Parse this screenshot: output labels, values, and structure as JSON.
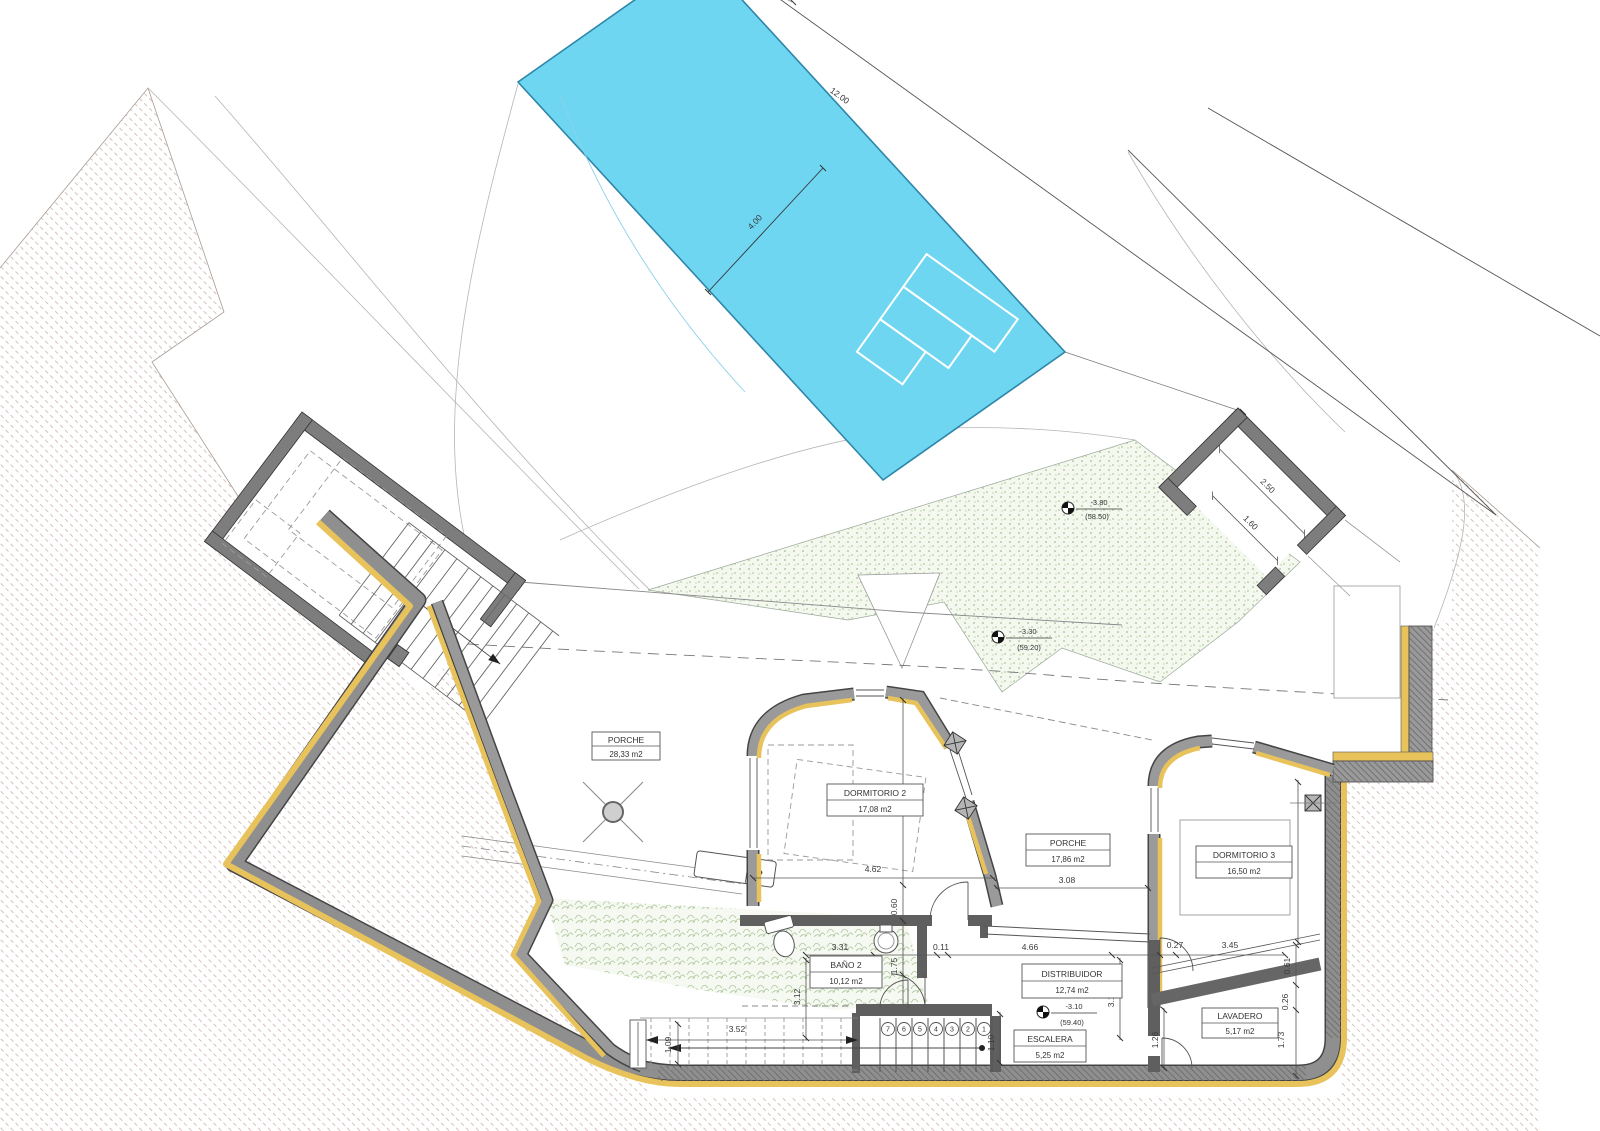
{
  "drawing": {
    "type": "architectural-floor-plan",
    "colors": {
      "pool_fill": "#6FD6F2",
      "pool_border": "#2E86A8",
      "insulation_yellow": "#E8C35B",
      "wall_gray": "#8F8F8F",
      "partition_gray": "#5F5F5F",
      "earth_hatch": "#D2BEB5",
      "vegetation_green": "#9CBF8C"
    }
  },
  "pool": {
    "length_label": "12.00",
    "width_label": "4.00"
  },
  "rooms": [
    {
      "name": "PORCHE",
      "area": "28,33 m2"
    },
    {
      "name": "DORMITORIO 2",
      "area": "17,08 m2"
    },
    {
      "name": "PORCHE",
      "area": "17,86 m2"
    },
    {
      "name": "DORMITORIO 3",
      "area": "16,50 m2"
    },
    {
      "name": "BAÑO 2",
      "area": "10,12 m2"
    },
    {
      "name": "DISTRIBUIDOR",
      "area": "12,74 m2"
    },
    {
      "name": "ESCALERA",
      "area": "5,25 m2"
    },
    {
      "name": "LAVADERO",
      "area": "5,17 m2"
    }
  ],
  "levels": [
    {
      "value": "-3.80",
      "elevation": "(58.50)"
    },
    {
      "value": "-3.30",
      "elevation": "(59.20)"
    },
    {
      "value": "-3.10",
      "elevation": "(59.40)"
    }
  ],
  "dims": [
    {
      "t": "12.00"
    },
    {
      "t": "4.00"
    },
    {
      "t": "2.50"
    },
    {
      "t": "1.60"
    },
    {
      "t": "3.53"
    },
    {
      "t": "4.62"
    },
    {
      "t": "3.08"
    },
    {
      "t": "3.96"
    },
    {
      "t": "0.60"
    },
    {
      "t": "3.31"
    },
    {
      "t": "0.11"
    },
    {
      "t": "1.75"
    },
    {
      "t": "4.66"
    },
    {
      "t": "0.27"
    },
    {
      "t": "3.45"
    },
    {
      "t": "3.13"
    },
    {
      "t": "3.12"
    },
    {
      "t": "1.10"
    },
    {
      "t": "1.26"
    },
    {
      "t": "0.61"
    },
    {
      "t": "0.26"
    },
    {
      "t": "1.73"
    },
    {
      "t": "3.52"
    },
    {
      "t": "1.09"
    }
  ],
  "stairs": {
    "numbers": [
      "7",
      "6",
      "5",
      "4",
      "3",
      "2",
      "1"
    ]
  }
}
